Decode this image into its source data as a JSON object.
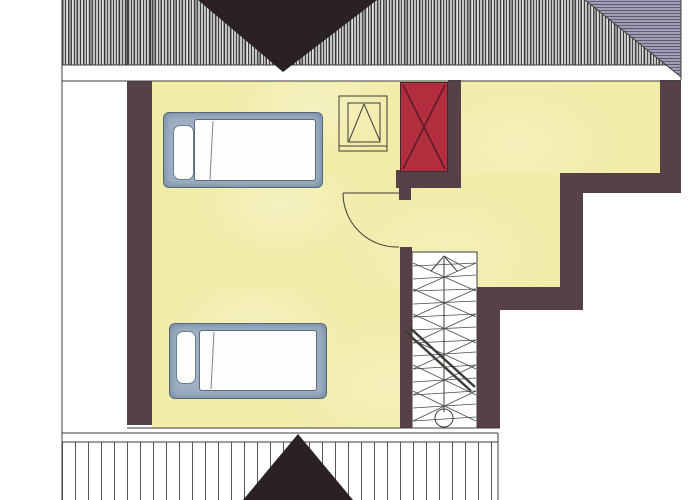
{
  "document": {
    "title": "Attic floor plan (scanned architectural drawing)",
    "type": "floor-plan",
    "visible_text": []
  },
  "colors": {
    "paper": "#ffffff",
    "floor": "#f1eca8",
    "floor_light": "#f7f2c2",
    "wall": "#564147",
    "chimney": "#b22e3e",
    "chimney_cross": "#5f1b28",
    "roof_hatch": "#c2c2c2",
    "roof_hatch_line": "#3a3a3a",
    "hip_shade": "#a29cb4",
    "dormer": "#292124",
    "bed_frame": "#9fb0c3",
    "bed_frame_edge": "#54677e",
    "mattress": "#fdfdfc",
    "line": "#3f3c38"
  },
  "rooms": [
    {
      "name": "bedroom",
      "floor_color": "floor",
      "fixtures": [
        "bed-top",
        "bed-bottom",
        "skylight-window"
      ]
    },
    {
      "name": "hallway-landing",
      "floor_color": "floor",
      "fixtures": [
        "chimney",
        "staircase",
        "door"
      ]
    }
  ],
  "fixtures": {
    "bed_count": 2,
    "chimney": {
      "symbol": "rectangle-with-x-cross",
      "color": "chimney"
    },
    "staircase": {
      "symbol": "winder-stairs",
      "markers": [
        "up-arrow",
        "start-circle",
        "break-line"
      ]
    },
    "door": {
      "symbol": "quarter-circle-swing",
      "hinge": "top"
    },
    "skylight": {
      "symbol": "nested-squares-with-v-lines"
    }
  },
  "roof": {
    "top_band": "dense-vertical-hatch",
    "top_dormer": "dark-triangle-apex-down",
    "hip_corner": "top-right-diagonal-with-horizontal-shading",
    "bottom_band": "spaced-vertical-lines",
    "bottom_dormer": "dark-triangle-apex-up"
  }
}
